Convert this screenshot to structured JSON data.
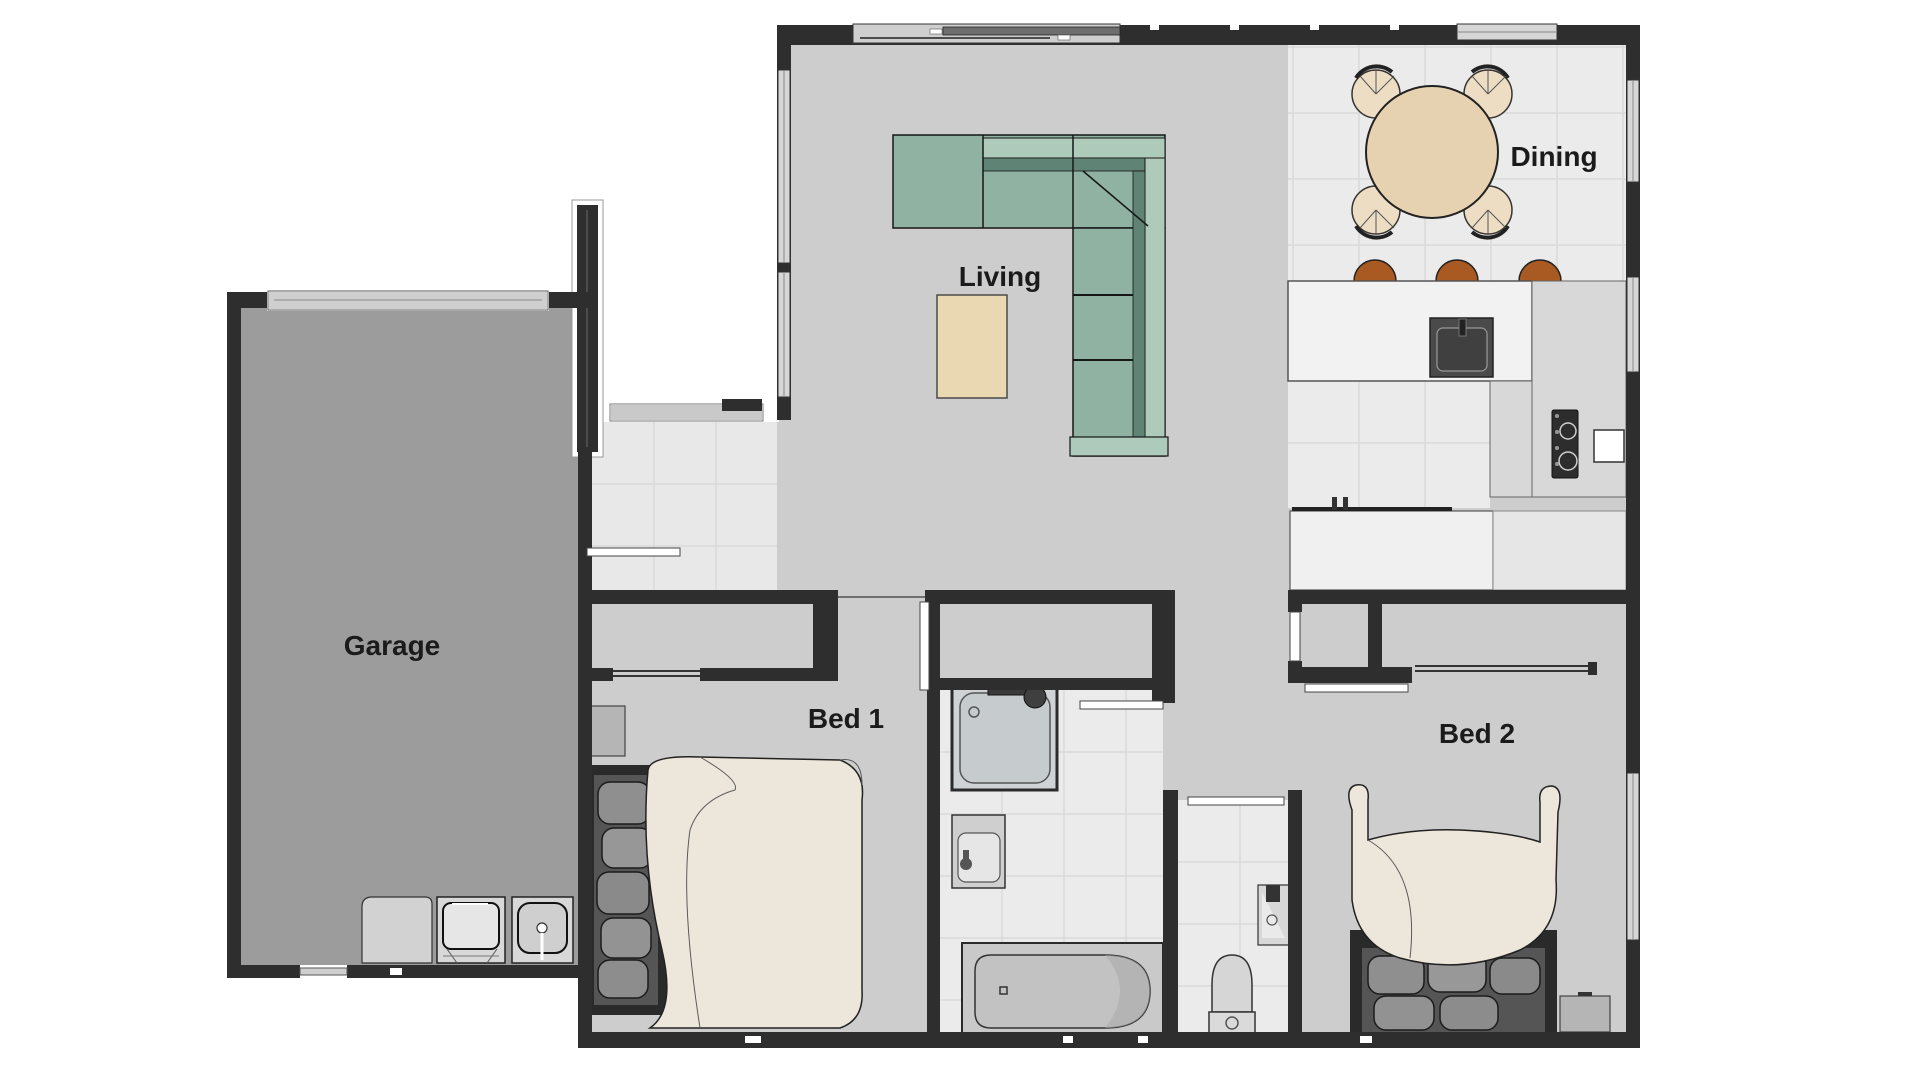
{
  "plan": {
    "type": "residential-floor-plan",
    "rooms": {
      "garage": {
        "label": "Garage"
      },
      "living": {
        "label": "Living"
      },
      "dining": {
        "label": "Dining"
      },
      "bed1": {
        "label": "Bed 1"
      },
      "bed2": {
        "label": "Bed 2"
      }
    },
    "fixtures": [
      "l-shaped-sofa",
      "coffee-table-rug",
      "round-dining-table",
      "dining-chairs",
      "kitchen-island",
      "island-sink",
      "bar-stools",
      "kitchen-counter",
      "counter-faucet",
      "cooktop",
      "oven",
      "tall-cabinets",
      "shower",
      "vanity-basin",
      "bathtub",
      "toilet",
      "wc-hand-basin",
      "bed1-bed",
      "bed1-nightstands",
      "bed2-bed",
      "bed2-nightstand",
      "garage-cabinet",
      "washing-machine",
      "laundry-tub",
      "garage-door",
      "entry-door",
      "windows",
      "sliding-wardrobe-doors"
    ],
    "palette": {
      "wall": "#2e2e2e",
      "floor_living": "#cdcdcd",
      "floor_garage": "#9c9c9c",
      "tile": "#ebebeb",
      "tile_entry": "#e8e8e8",
      "tile_grout": "#d9d9d9",
      "sofa": "#8fb2a2",
      "sofa_light": "#aecabb",
      "sofa_shadow": "#5f8375",
      "rug": "#ead8b2",
      "dining_table": "#e6d2b1",
      "dining_chair": "#ecddc3",
      "bar_stool": "#a85a22",
      "counter": "#f0f0f0",
      "cabinet": "#d8d8d8",
      "appliance_dark": "#3a3a3a",
      "bed_duvet": "#ede7db",
      "pillow_stone": "#8f8f8f",
      "label_text": "#1b1b1b"
    }
  }
}
